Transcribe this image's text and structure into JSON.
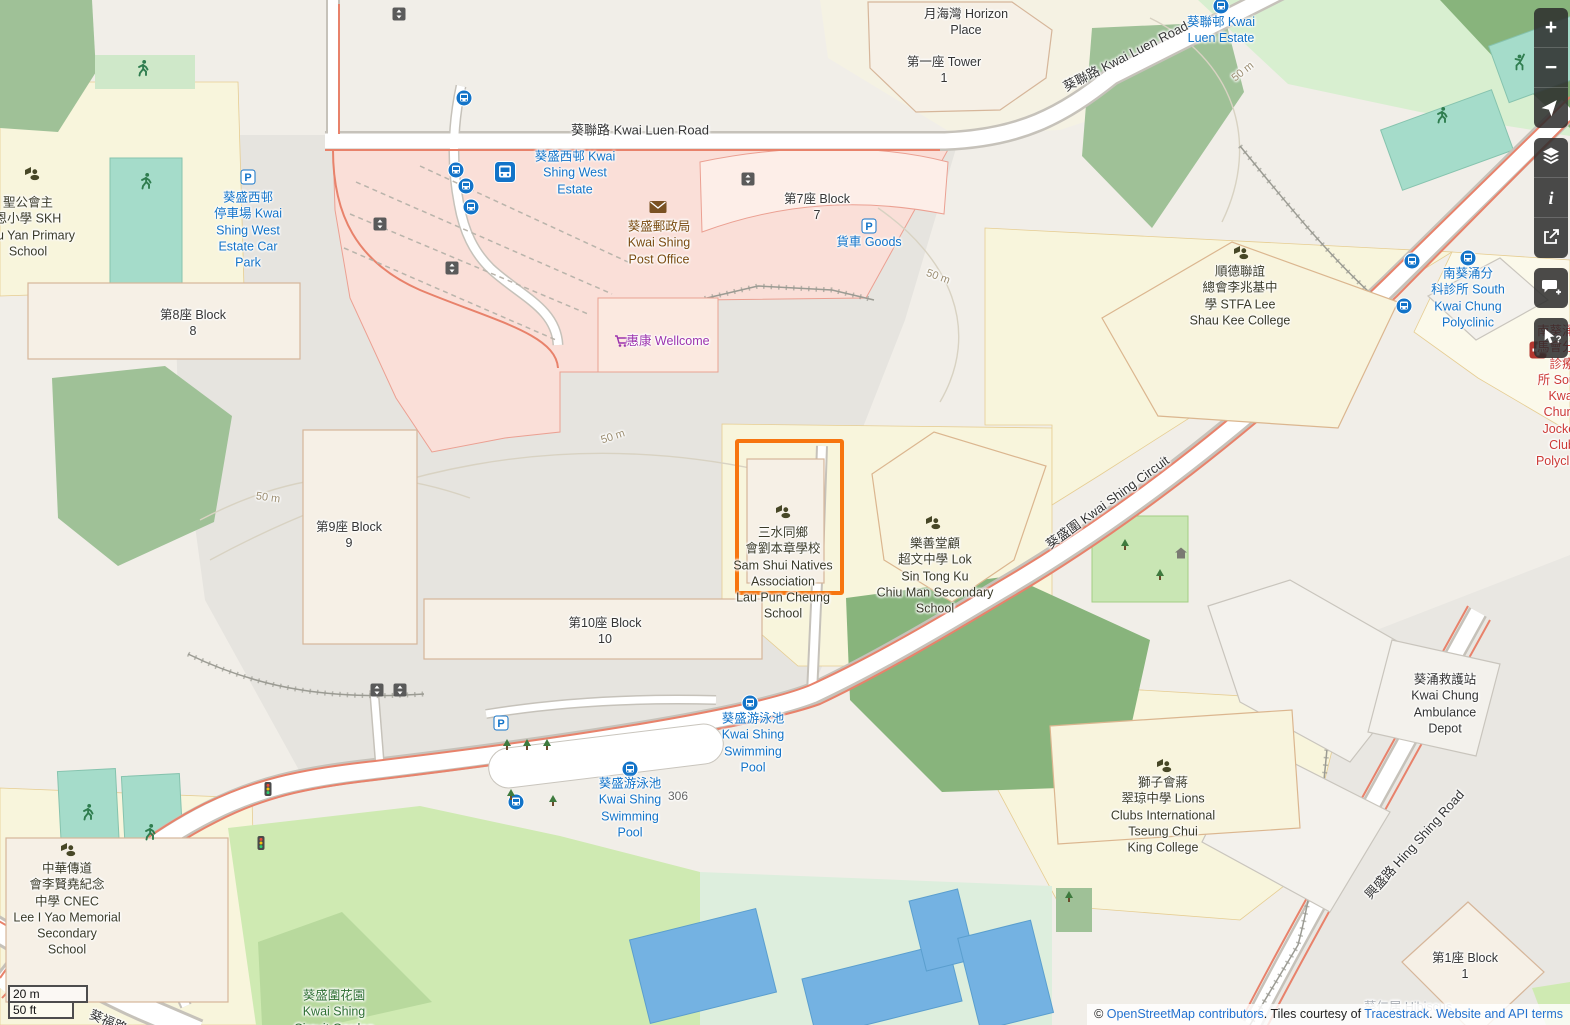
{
  "colors": {
    "selection_orange": "#f7750f",
    "link_blue": "#2573d0",
    "transit_label_blue": "#1273c8",
    "amenity_brown": "#7a4b10",
    "shop_purple": "#9c33ad",
    "health_red": "#cc3a36",
    "park_green": "#2f7033",
    "land_base": "#f1eee8"
  },
  "map": {
    "selection_box": {
      "x": 735,
      "y": 439,
      "width": 101,
      "height": 148
    },
    "labels": [
      {
        "name": "horizon-place",
        "text": "月海灣 Horizon\nPlace",
        "x": 966,
        "y": 22,
        "color": "#343434"
      },
      {
        "name": "tower-1",
        "text": "第一座 Tower\n1",
        "x": 944,
        "y": 70,
        "color": "#343434"
      },
      {
        "name": "kwai-luen-road",
        "text": "葵聯路 Kwai Luen Road",
        "x": 640,
        "y": 131,
        "color": "#343434",
        "size": 13
      },
      {
        "name": "kwai-luen-road-2",
        "text": "葵聯路 Kwai Luen Road",
        "x": 1126,
        "y": 57,
        "color": "#343434",
        "size": 13,
        "rot": -27
      },
      {
        "name": "kwai-luen-estate",
        "text": "葵聯邨 Kwai\nLuen Estate",
        "x": 1221,
        "y": 30,
        "color": "#1273c8"
      },
      {
        "name": "skh-chu-yan-primary-school",
        "text": "聖公會主\n恩小學 SKH\nChu Yan Primary\nSchool",
        "x": 28,
        "y": 227,
        "color": "#3a3a28"
      },
      {
        "name": "kwai-shing-west-estate-car-park",
        "text": "葵盛西邨\n停車場 Kwai\nShing West\nEstate Car\nPark",
        "x": 248,
        "y": 230,
        "color": "#1273c8"
      },
      {
        "name": "block-8",
        "text": "第8座 Block\n8",
        "x": 193,
        "y": 323,
        "color": "#343434"
      },
      {
        "name": "kwai-shing-west-estate",
        "text": "葵盛西邨 Kwai\nShing West\nEstate",
        "x": 575,
        "y": 173,
        "color": "#1273c8"
      },
      {
        "name": "kwai-shing-post-office",
        "text": "葵盛郵政局\nKwai Shing\nPost Office",
        "x": 659,
        "y": 243,
        "color": "#7a4b10"
      },
      {
        "name": "block-7",
        "text": "第7座 Block\n7",
        "x": 817,
        "y": 207,
        "color": "#343434"
      },
      {
        "name": "goods-vehicle-park",
        "text": "貨車 Goods",
        "x": 869,
        "y": 242,
        "color": "#1273c8"
      },
      {
        "name": "wellcome",
        "text": "惠康 Wellcome",
        "x": 668,
        "y": 341,
        "color": "#9c33ad"
      },
      {
        "name": "block-9",
        "text": "第9座 Block\n9",
        "x": 349,
        "y": 535,
        "color": "#343434"
      },
      {
        "name": "sam-shui-natives-association-school",
        "text": "三水同鄉\n會劉本章學校\nSam Shui Natives\nAssociation\nLau Pun Cheung\nSchool",
        "x": 783,
        "y": 573,
        "color": "#3a3a28"
      },
      {
        "name": "lok-sin-tong-ku-chiu-man-school",
        "text": "樂善堂顧\n超文中學 Lok\nSin Tong Ku\nChiu Man Secondary\nSchool",
        "x": 935,
        "y": 576,
        "color": "#3a3a28"
      },
      {
        "name": "stfa-lee-shau-kee-college",
        "text": "順德聯誼\n總會李兆基中\n學 STFA Lee\nShau Kee College",
        "x": 1240,
        "y": 296,
        "color": "#3a3a28"
      },
      {
        "name": "south-kwai-chung-polyclinic",
        "text": "南葵涌分\n科診所 South\nKwai Chung\nPolyclinic",
        "x": 1468,
        "y": 298,
        "color": "#1273c8"
      },
      {
        "name": "south-kwai-chung-jockey-club-polyclinic",
        "text": "南葵涌賽\n馬會分科診療\n所 South Kwai\nChung Jockey\nClub Polyclinic",
        "x": 1562,
        "y": 396,
        "color": "#cc3a36"
      },
      {
        "name": "kwai-shing-circuit",
        "text": "葵盛圍 Kwai Shing Circuit",
        "x": 1108,
        "y": 503,
        "color": "#343434",
        "size": 13,
        "rot": -36
      },
      {
        "name": "block-10",
        "text": "第10座 Block\n10",
        "x": 605,
        "y": 631,
        "color": "#343434"
      },
      {
        "name": "kwai-shing-swimming-pool-1",
        "text": "葵盛游泳池\nKwai Shing\nSwimming\nPool",
        "x": 753,
        "y": 743,
        "color": "#1273c8"
      },
      {
        "name": "kwai-shing-swimming-pool-2",
        "text": "葵盛游泳池\nKwai Shing\nSwimming\nPool",
        "x": 630,
        "y": 808,
        "color": "#1273c8"
      },
      {
        "name": "house-number-306",
        "text": "306",
        "x": 678,
        "y": 797,
        "color": "#666666",
        "size": 12
      },
      {
        "name": "cnec-lee-i-yao-memorial-school",
        "text": "中華傳道\n會李賢堯紀念\n中學 CNEC\nLee I Yao Memorial\nSecondary\nSchool",
        "x": 67,
        "y": 909,
        "color": "#3a3a28"
      },
      {
        "name": "lions-clubs-tseung-chui-king-college",
        "text": "獅子會蔣\n翠琼中學 Lions\nClubs International\nTseung Chui\nKing College",
        "x": 1163,
        "y": 815,
        "color": "#3a3a28"
      },
      {
        "name": "kwai-chung-ambulance-depot",
        "text": "葵涌救護站\nKwai Chung\nAmbulance\nDepot",
        "x": 1445,
        "y": 704,
        "color": "#343434"
      },
      {
        "name": "hing-shing-road",
        "text": "興盛路 Hing Shing Road",
        "x": 1415,
        "y": 845,
        "color": "#343434",
        "size": 13,
        "rot": -48
      },
      {
        "name": "block-1",
        "text": "第1座 Block\n1",
        "x": 1465,
        "y": 966,
        "color": "#343434"
      },
      {
        "name": "kwai-shing-circuit-garden",
        "text": "葵盛圍花園\nKwai Shing\nCircuit Garden",
        "x": 334,
        "y": 1012,
        "color": "#2f7033"
      },
      {
        "name": "kwai-fuk-road",
        "text": "葵福路 Kwai Fuk Road",
        "x": 150,
        "y": 1040,
        "color": "#343434",
        "size": 13,
        "rot": 23
      },
      {
        "name": "hibiscus-faded",
        "text": "葵仁居 Hibiscus",
        "x": 1408,
        "y": 1007,
        "color": "#a8adb3"
      },
      {
        "name": "contour-50m-a",
        "text": "50 m",
        "x": 268,
        "y": 498,
        "color": "#9b8d71",
        "size": 11,
        "rot": 8
      },
      {
        "name": "contour-50m-b",
        "text": "50 m",
        "x": 613,
        "y": 437,
        "color": "#9b8d71",
        "size": 11,
        "rot": -18
      },
      {
        "name": "contour-50m-c",
        "text": "50 m",
        "x": 938,
        "y": 277,
        "color": "#9b8d71",
        "size": 11,
        "rot": 20
      },
      {
        "name": "contour-50m-d",
        "text": "50 m",
        "x": 1243,
        "y": 72,
        "color": "#9b8d71",
        "size": 11,
        "rot": -38
      }
    ],
    "icons": [
      {
        "type": "bus-stop",
        "x": 464,
        "y": 98
      },
      {
        "type": "bus-stop",
        "x": 456,
        "y": 170
      },
      {
        "type": "bus-stop",
        "x": 466,
        "y": 186
      },
      {
        "type": "bus-stop",
        "x": 471,
        "y": 207
      },
      {
        "type": "bus-stop",
        "x": 750,
        "y": 703
      },
      {
        "type": "bus-stop",
        "x": 630,
        "y": 769
      },
      {
        "type": "bus-stop",
        "x": 516,
        "y": 802
      },
      {
        "type": "bus-stop",
        "x": 1221,
        "y": 6
      },
      {
        "type": "bus-stop",
        "x": 1412,
        "y": 261
      },
      {
        "type": "bus-stop",
        "x": 1468,
        "y": 258
      },
      {
        "type": "bus-stop",
        "x": 1404,
        "y": 306
      },
      {
        "type": "bus-station",
        "x": 505,
        "y": 172
      },
      {
        "type": "parking",
        "x": 248,
        "y": 177
      },
      {
        "type": "parking",
        "x": 869,
        "y": 226
      },
      {
        "type": "parking",
        "x": 501,
        "y": 723
      },
      {
        "type": "mail",
        "x": 658,
        "y": 207
      },
      {
        "type": "school",
        "x": 32,
        "y": 173
      },
      {
        "type": "school",
        "x": 783,
        "y": 511
      },
      {
        "type": "school",
        "x": 933,
        "y": 522
      },
      {
        "type": "school",
        "x": 1241,
        "y": 252
      },
      {
        "type": "school",
        "x": 68,
        "y": 849
      },
      {
        "type": "school",
        "x": 1164,
        "y": 765
      },
      {
        "type": "hospital",
        "x": 1538,
        "y": 350,
        "z": 56
      },
      {
        "type": "elevator",
        "x": 399,
        "y": 14
      },
      {
        "type": "elevator",
        "x": 380,
        "y": 224
      },
      {
        "type": "elevator",
        "x": 452,
        "y": 268
      },
      {
        "type": "elevator",
        "x": 748,
        "y": 179
      },
      {
        "type": "elevator",
        "x": 377,
        "y": 690
      },
      {
        "type": "elevator",
        "x": 400,
        "y": 690
      },
      {
        "type": "shopping-cart",
        "x": 622,
        "y": 341
      },
      {
        "type": "runner",
        "x": 146,
        "y": 181
      },
      {
        "type": "runner",
        "x": 143,
        "y": 68
      },
      {
        "type": "runner",
        "x": 88,
        "y": 812
      },
      {
        "type": "runner",
        "x": 150,
        "y": 832
      },
      {
        "type": "runner",
        "x": 1442,
        "y": 115
      },
      {
        "type": "tennis-player",
        "x": 1520,
        "y": 62
      },
      {
        "type": "traffic-light",
        "x": 268,
        "y": 789
      },
      {
        "type": "traffic-light",
        "x": 261,
        "y": 843
      },
      {
        "type": "tree",
        "x": 507,
        "y": 745
      },
      {
        "type": "tree",
        "x": 527,
        "y": 745
      },
      {
        "type": "tree",
        "x": 547,
        "y": 745
      },
      {
        "type": "tree",
        "x": 511,
        "y": 795
      },
      {
        "type": "tree",
        "x": 553,
        "y": 801
      },
      {
        "type": "tree",
        "x": 1069,
        "y": 897
      },
      {
        "type": "tree",
        "x": 1125,
        "y": 545
      },
      {
        "type": "tree",
        "x": 1160,
        "y": 575
      },
      {
        "type": "home",
        "x": 1181,
        "y": 553
      }
    ]
  },
  "controls": {
    "buttons": [
      {
        "name": "zoom-in-button",
        "icon": "plus-icon",
        "glyph": "+",
        "group": 1
      },
      {
        "name": "zoom-out-button",
        "icon": "minus-icon",
        "glyph": "−",
        "group": 1
      },
      {
        "name": "show-my-location-button",
        "icon": "navigation-arrow-icon",
        "group": 1
      },
      {
        "name": "layers-button",
        "icon": "layers-icon",
        "group": 2
      },
      {
        "name": "map-key-button",
        "icon": "info-icon",
        "glyph": "i",
        "group": 2
      },
      {
        "name": "share-button",
        "icon": "share-icon",
        "group": 2
      },
      {
        "name": "add-note-button",
        "icon": "note-plus-icon",
        "group": 3
      },
      {
        "name": "query-features-button",
        "icon": "query-arrow-icon",
        "group": 4
      }
    ]
  },
  "scale_bar": {
    "metric": "20 m",
    "imperial": "50 ft"
  },
  "attribution": {
    "copyright": "© ",
    "osm_link": "OpenStreetMap contributors",
    "separator1": ". Tiles courtesy of ",
    "tracestrack_link": "Tracestrack",
    "separator2": ". ",
    "terms_link": "Website and API terms"
  }
}
